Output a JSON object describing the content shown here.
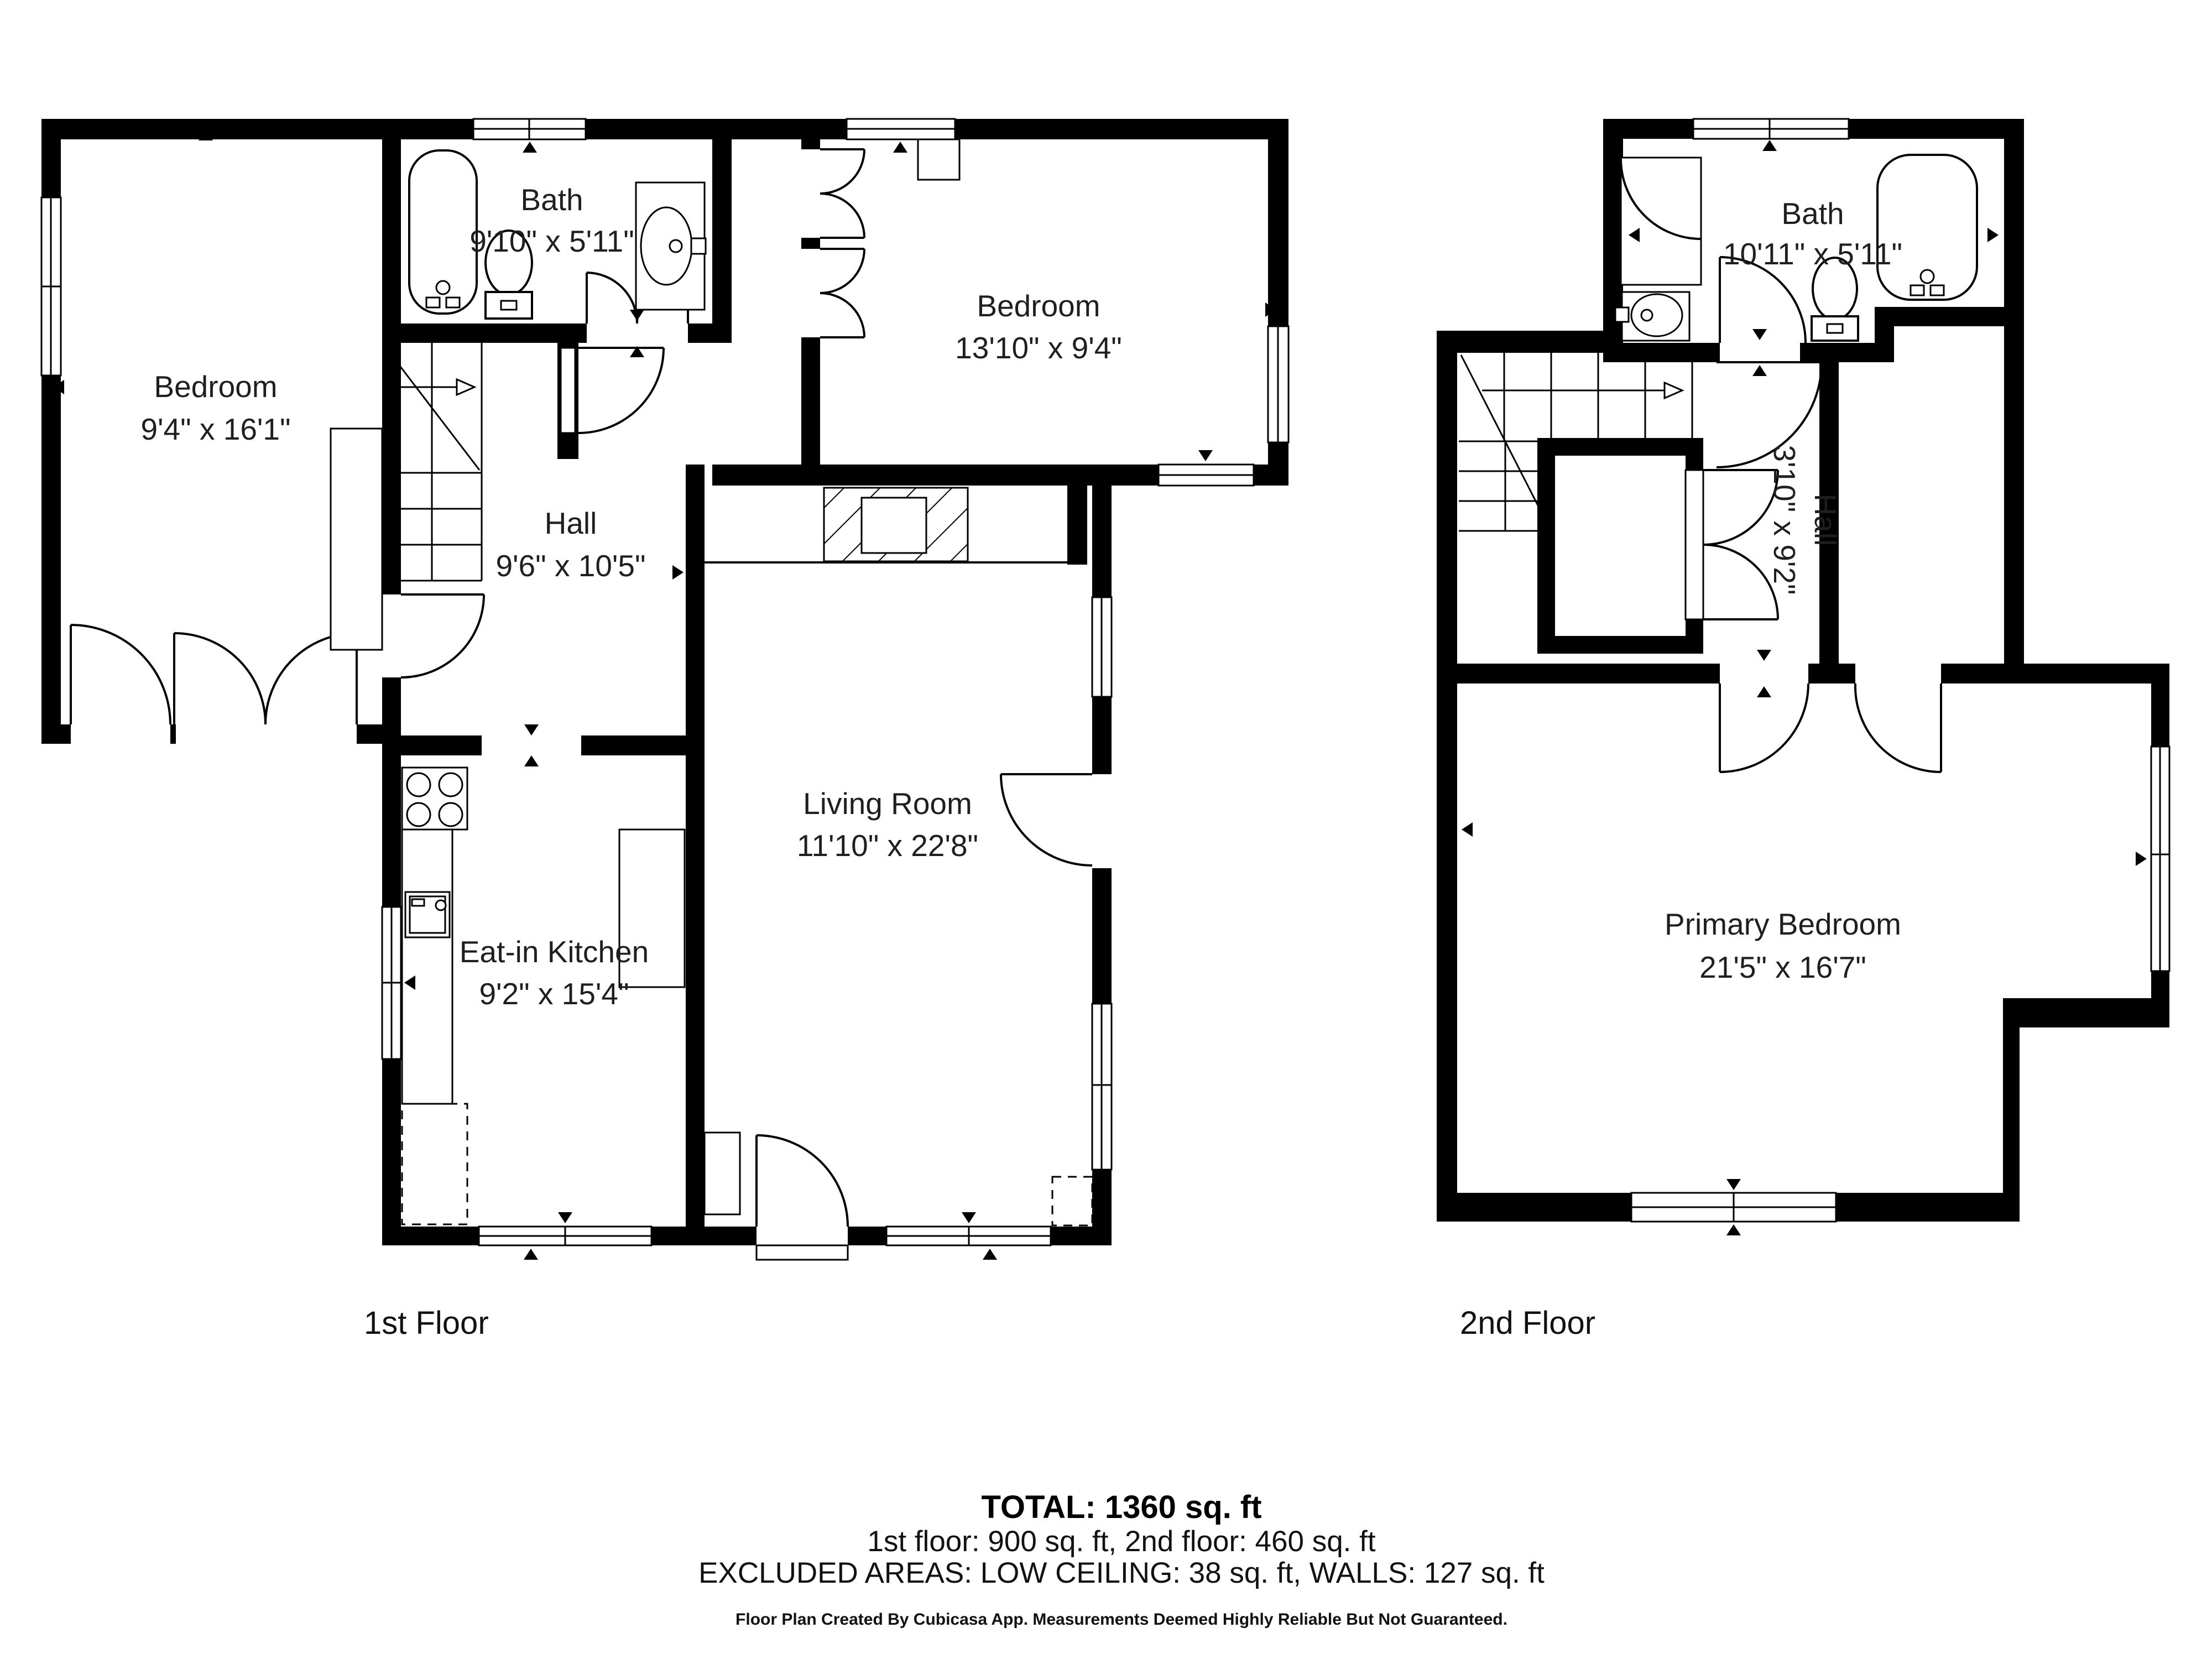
{
  "floors": [
    {
      "label": "1st Floor",
      "rooms": [
        {
          "name": "Bedroom",
          "dims": "9'4\" x 16'1\""
        },
        {
          "name": "Bath",
          "dims": "9'10\" x 5'11\""
        },
        {
          "name": "Bedroom",
          "dims": "13'10\" x 9'4\""
        },
        {
          "name": "Hall",
          "dims": "9'6\" x 10'5\""
        },
        {
          "name": "Living Room",
          "dims": "11'10\" x 22'8\""
        },
        {
          "name": "Eat-in Kitchen",
          "dims": "9'2\" x 15'4\""
        }
      ]
    },
    {
      "label": "2nd Floor",
      "rooms": [
        {
          "name": "Bath",
          "dims": "10'11\" x 5'11\""
        },
        {
          "name": "Hall",
          "dims": "3'10\" x 9'2\""
        },
        {
          "name": "Primary Bedroom",
          "dims": "21'5\" x 16'7\""
        }
      ]
    }
  ],
  "summary": {
    "total": "TOTAL: 1360 sq. ft",
    "floors_line": "1st floor: 900 sq. ft, 2nd floor: 460 sq. ft",
    "excluded_line": "EXCLUDED AREAS: LOW CEILING: 38 sq. ft, WALLS: 127 sq. ft",
    "disclaimer": "Floor Plan Created By Cubicasa App. Measurements Deemed Highly Reliable But Not Guaranteed."
  },
  "colors": {
    "wall": "#000000",
    "background": "#ffffff",
    "text": "#1f1f1f"
  }
}
